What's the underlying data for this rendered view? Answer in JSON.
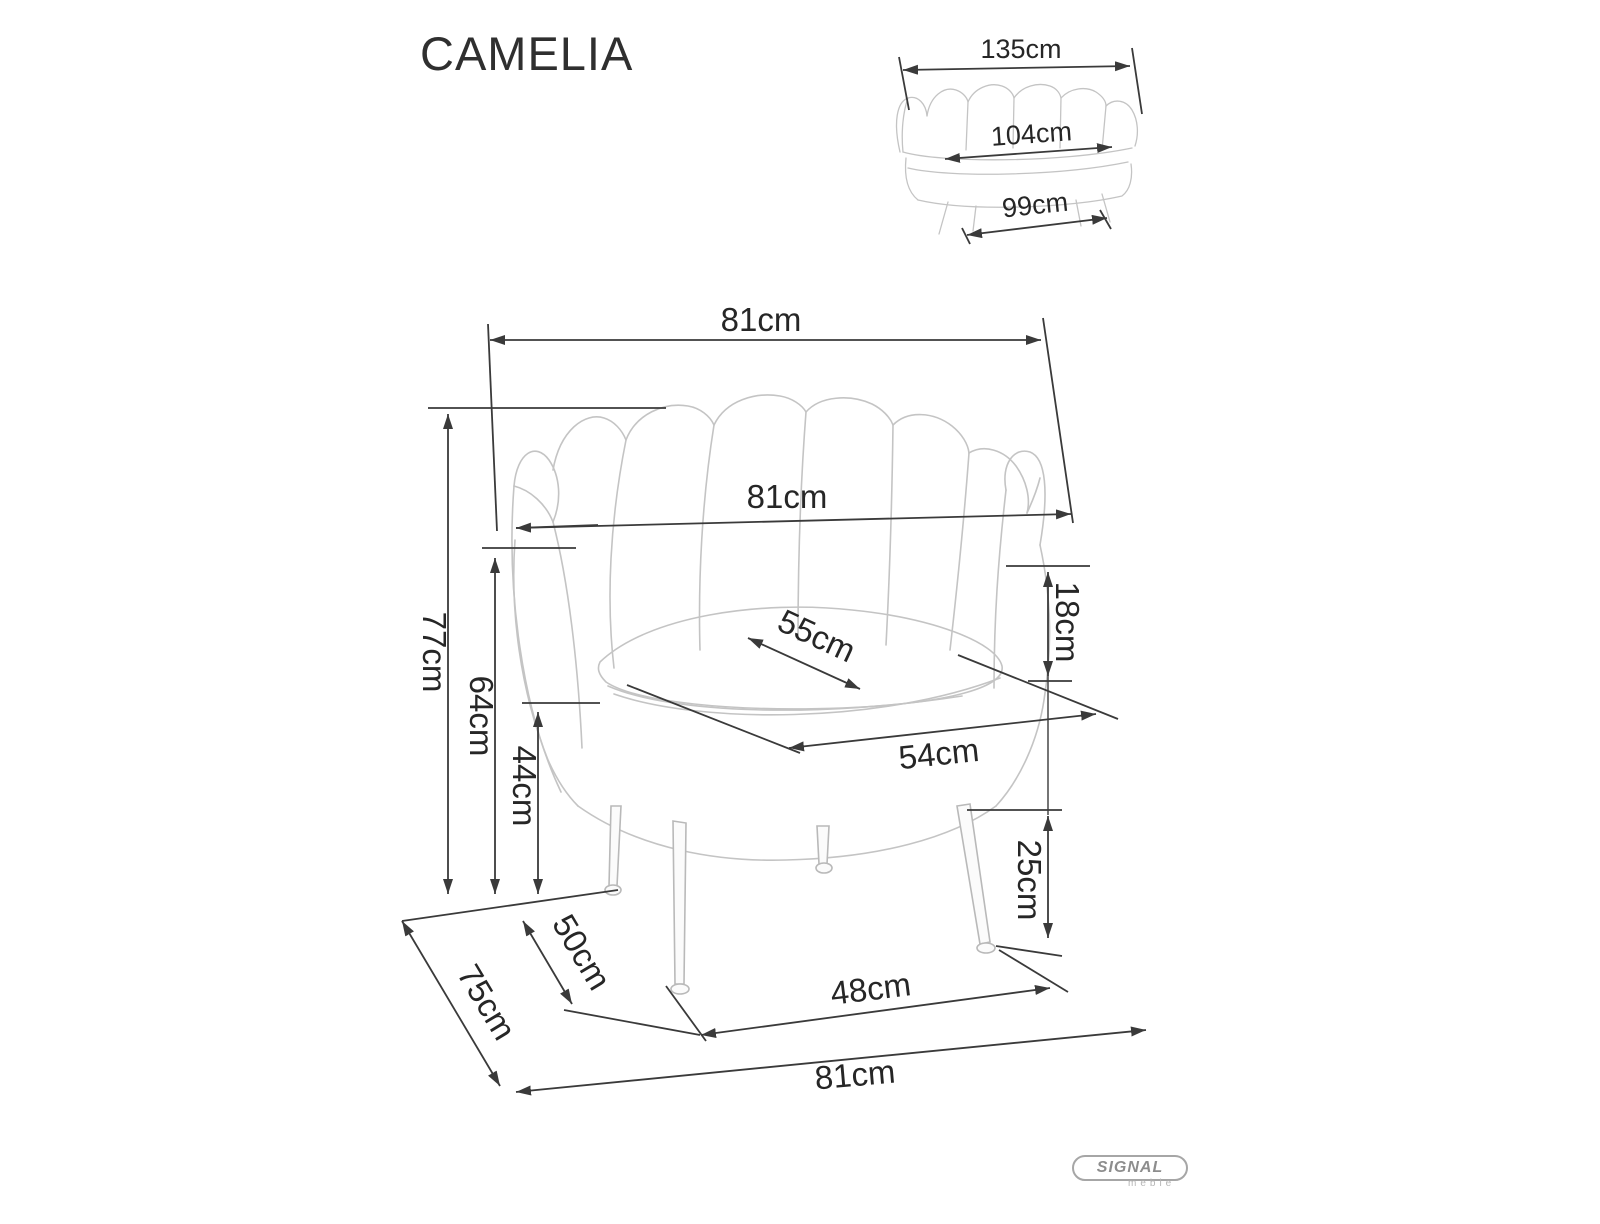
{
  "page": {
    "title": "CAMELIA"
  },
  "sofa_thumbnail": {
    "description": "two-seater shell sofa front view",
    "dimensions": {
      "total_width": "135cm",
      "seat_width": "104cm",
      "base_width": "99cm"
    }
  },
  "armchair": {
    "description": "shell armchair front view",
    "dimensions": {
      "total_width_top": "81cm",
      "backrest_width": "81cm",
      "total_height": "77cm",
      "armrest_height": "64cm",
      "seat_height": "44cm",
      "seat_depth_diagonal": "55cm",
      "seat_width": "54cm",
      "backrest_above_seat": "18cm",
      "leg_height": "25cm",
      "front_leg_spacing": "48cm",
      "total_depth": "75cm",
      "leg_depth_spacing": "50cm",
      "total_width_bottom": "81cm"
    }
  },
  "brand": {
    "name": "SIGNAL",
    "subtitle": "meble"
  },
  "colors": {
    "dimension_lines": "#3a3a3a",
    "artwork_lines": "#c4c4c4",
    "label_text": "#262626",
    "brand_gray": "#9a9a9a"
  }
}
